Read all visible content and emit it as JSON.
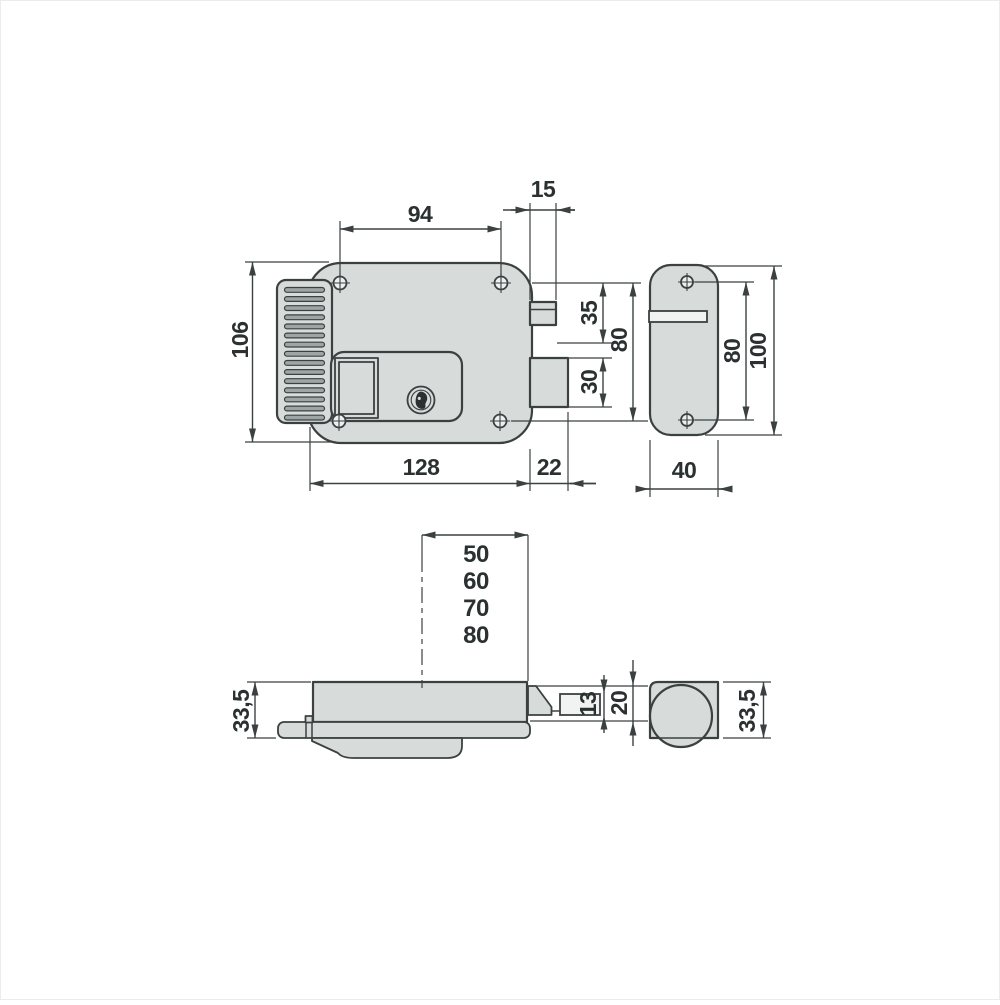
{
  "drawing": {
    "type": "electric rim lock technical dimension drawing",
    "units": "mm"
  },
  "style": {
    "line_color": "#3b4141",
    "fill_color": "#d7dbda",
    "slat_color": "#9ea5a5",
    "text_color": "#2b3030"
  },
  "dims": {
    "front": {
      "hole_spacing": "94",
      "edge_to_latch": "15",
      "body_height": "106",
      "latch_section": "35",
      "bolt_section": "30",
      "hole_row_spacing": "80",
      "body_width": "128",
      "bolt_throw": "22"
    },
    "strike": {
      "hole_spacing": "80",
      "height": "100",
      "width": "40"
    },
    "bottom": {
      "backsets": [
        "50",
        "60",
        "70",
        "80"
      ],
      "body_depth": "33,5",
      "lip": "13",
      "channel": "20",
      "cylinder_depth": "33,5"
    }
  }
}
